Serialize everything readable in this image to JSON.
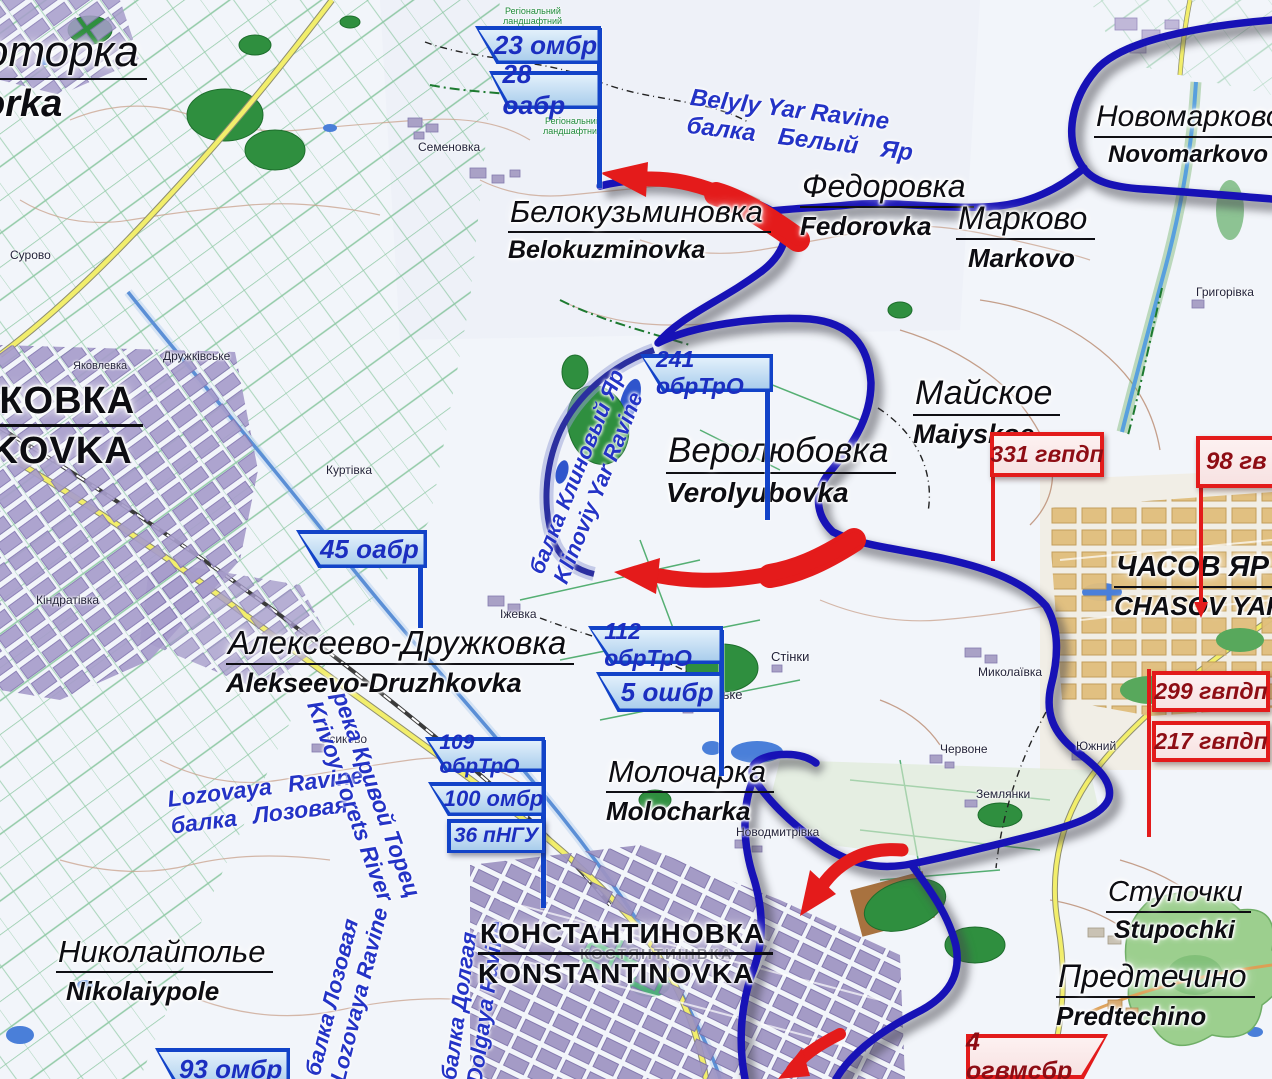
{
  "colors": {
    "front_line": "#1712b6",
    "attack_arrow": "#e41b1b",
    "blue_flag_border": "#1243c8",
    "red_flag_border": "#e31b1b"
  },
  "flags": {
    "blue": [
      {
        "label": "23 омбр"
      },
      {
        "label": "28 оабр"
      },
      {
        "label": "241 обрТрО"
      },
      {
        "label": "45 оабр"
      },
      {
        "label": "112 обрТрО"
      },
      {
        "label": "5 ошбр"
      },
      {
        "label": "109 обрТрО"
      },
      {
        "label": "100 омбр"
      },
      {
        "label": "36 пНГУ"
      },
      {
        "label": "93 омбр"
      }
    ],
    "red": [
      {
        "label": "331 гвпдп"
      },
      {
        "label": "98 гв"
      },
      {
        "label": "299 гвпдп"
      },
      {
        "label": "217 гвпдп"
      },
      {
        "label": "4 огвмсбр"
      }
    ]
  },
  "places": [
    {
      "name": "Белокузьминовка",
      "translit": "Belokuzminovka"
    },
    {
      "name": "Федоровка",
      "translit": "Fedorovka"
    },
    {
      "name": "Марково",
      "translit": "Markovo"
    },
    {
      "name": "Новомарково",
      "translit": "Novomarkovo"
    },
    {
      "name": "Веролюбовка",
      "translit": "Verolyubovka"
    },
    {
      "name": "Майское",
      "translit": "Maiyskoe"
    },
    {
      "name": "ЧАСОВ ЯР",
      "translit": "CHASOV YAR"
    },
    {
      "name": "Алексеево-Дружковка",
      "translit": "Alekseevo-Druzhkovka"
    },
    {
      "name": "Молочарка",
      "translit": "Molocharka"
    },
    {
      "name": "КОНСТАНТИНОВКА",
      "translit": "KONSTANTINOVKA"
    },
    {
      "name": "Николайполье",
      "translit": "Nikolaiypole"
    },
    {
      "name": "Ступочки",
      "translit": "Stupochki"
    },
    {
      "name": "Предтечино",
      "translit": "Predtechino"
    },
    {
      "name": "оторка",
      "translit": "orka"
    },
    {
      "name": "ЖКОВКА",
      "translit": "HKOVKA"
    }
  ],
  "water_labels": [
    {
      "line1": "Belyly Yar Ravine",
      "line2": "балка Белый Яр"
    },
    {
      "line1": "балка Клиновый Яр",
      "line2": "Klinoviy Yar Ravine"
    },
    {
      "line1": "Lozovaya Ravine",
      "line2": "балка Лозовая"
    },
    {
      "line1": "река Кривой Торец",
      "line2": "Krivoy Torets River"
    },
    {
      "line1": "балка Лозовая",
      "line2": "Lozovaya Ravine"
    },
    {
      "line1": "балка Долгая",
      "line2": "Dolgaya Ravine"
    }
  ],
  "map_labels": [
    "Семеновка",
    "Дружківське",
    "Яковлевка",
    "Сурово",
    "Куртівка",
    "Кіндратівка",
    "Іжевка",
    "Стінки",
    "Подільське",
    "Миколаївка",
    "Червоне",
    "Южний",
    "Землянки",
    "Новодмитрівка",
    "Осиково",
    "Григорівка",
    "КОСТЯНТИНІВКА"
  ],
  "park_labels": [
    "Регіональний",
    "ландшафтний"
  ]
}
